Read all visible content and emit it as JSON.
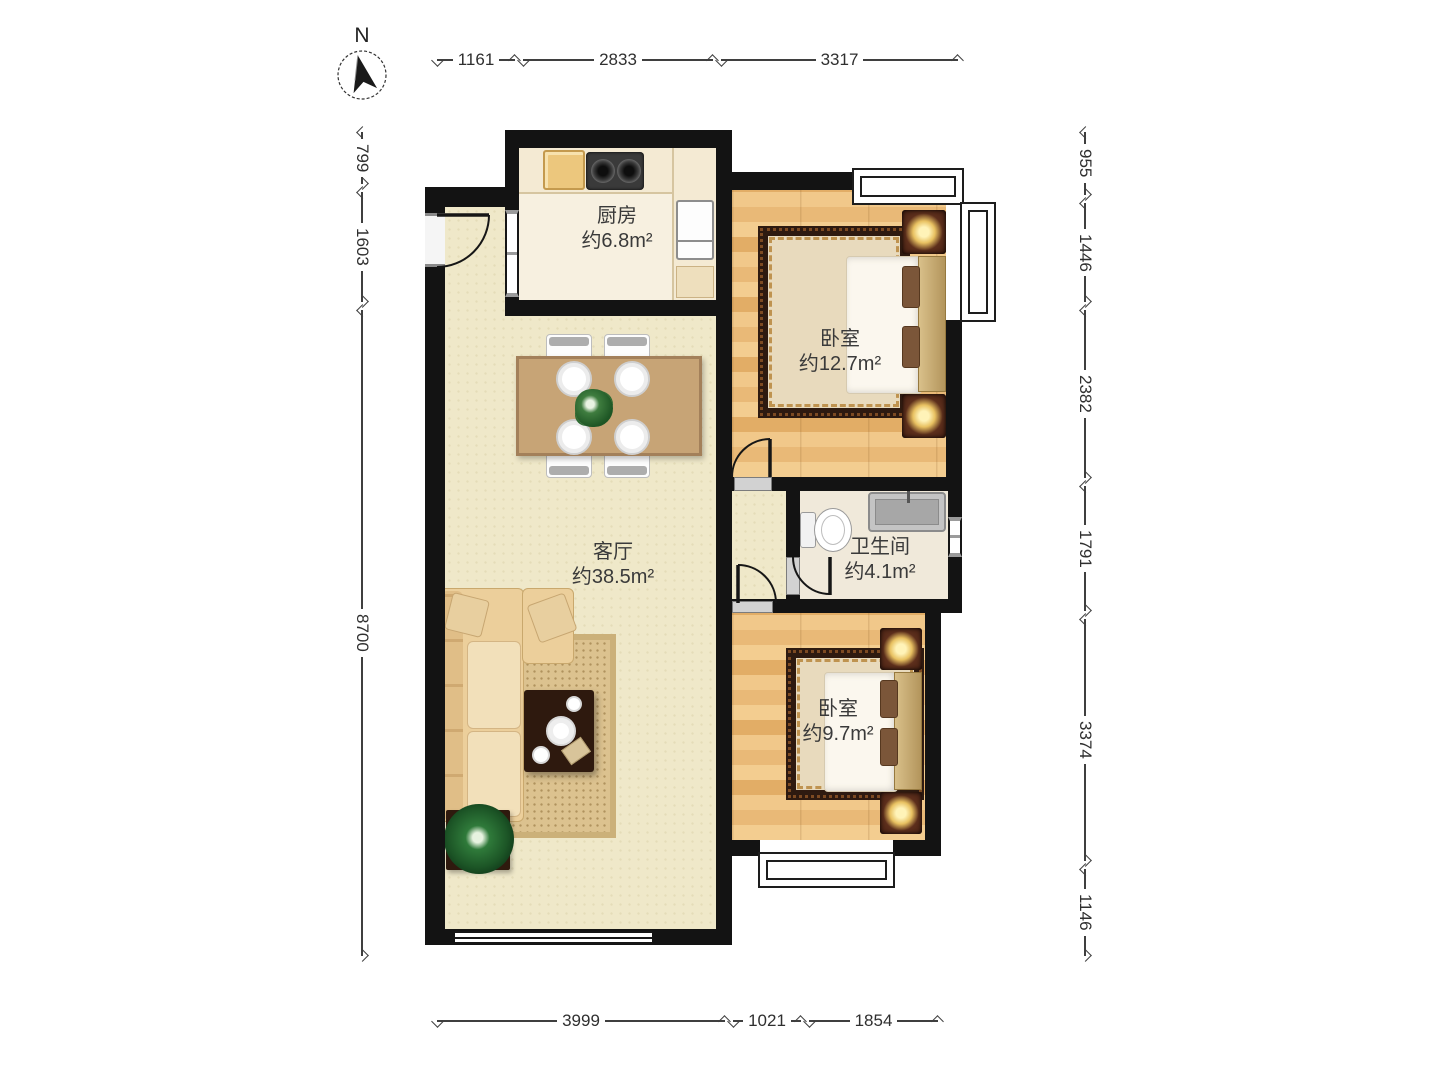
{
  "compass": {
    "north_label": "N"
  },
  "rooms": {
    "kitchen": {
      "name": "厨房",
      "area": "约6.8m²"
    },
    "bedroom_north": {
      "name": "卧室",
      "area": "约12.7m²"
    },
    "living": {
      "name": "客厅",
      "area": "约38.5m²"
    },
    "bathroom": {
      "name": "卫生间",
      "area": "约4.1m²"
    },
    "bedroom_south": {
      "name": "卧室",
      "area": "约9.7m²"
    }
  },
  "dimensions": {
    "top": [
      {
        "label": "1161"
      },
      {
        "label": "2833"
      },
      {
        "label": "3317"
      }
    ],
    "bottom": [
      {
        "label": "3999"
      },
      {
        "label": "1021"
      },
      {
        "label": "1854"
      }
    ],
    "left": [
      {
        "label": "799"
      },
      {
        "label": "1603"
      },
      {
        "label": "8700"
      }
    ],
    "right": [
      {
        "label": "955"
      },
      {
        "label": "1446"
      },
      {
        "label": "2382"
      },
      {
        "label": "1791"
      },
      {
        "label": "3374"
      },
      {
        "label": "1146"
      }
    ]
  },
  "palette": {
    "wall": "#131313",
    "living_floor": "#efe8c9",
    "wood_floor": "#e9b977",
    "kitchen_floor": "#f7f0e0",
    "bath_floor": "#f0e9da",
    "dimension_line": "#3f3f3f",
    "label_text": "#3a3a3a",
    "lamp_glow": "#fff3b8"
  },
  "icons": {
    "compass": "north-arrow-icon",
    "kitchen": [
      "stove-icon",
      "cutting-board-icon",
      "fridge-icon"
    ],
    "bathroom": [
      "toilet-icon",
      "sink-icon"
    ],
    "bedrooms": [
      "bed-icon",
      "nightstand-lamp-icon",
      "rug-icon"
    ],
    "living": [
      "sofa-icon",
      "coffee-table-icon",
      "dining-table-icon",
      "chair-icon",
      "plant-icon"
    ]
  }
}
